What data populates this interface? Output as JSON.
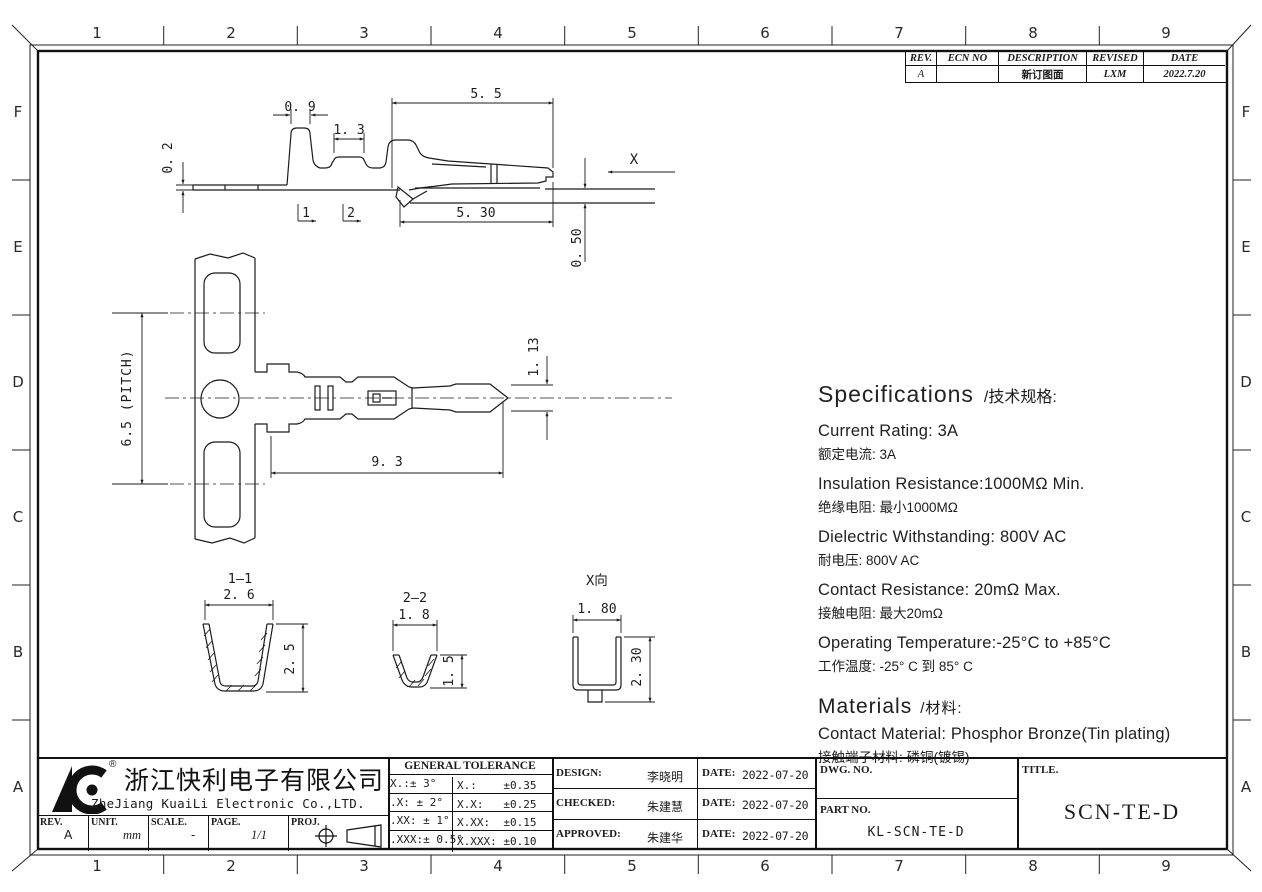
{
  "page": {
    "bg": "#ffffff",
    "line_color": "#1c1c1c"
  },
  "grid": {
    "cols": [
      "1",
      "2",
      "3",
      "4",
      "5",
      "6",
      "7",
      "8",
      "9"
    ],
    "rows": [
      "F",
      "E",
      "D",
      "C",
      "B",
      "A"
    ]
  },
  "rev_table": {
    "col_rev": "REV.",
    "col_ecn": "ECN NO",
    "col_desc": "DESCRIPTION",
    "col_revised": "REVISED",
    "col_date": "DATE",
    "rev": "A",
    "ecn": "",
    "desc": "新订图面",
    "revised": "LXM",
    "date": "2022.7.20"
  },
  "dims": {
    "side": {
      "w1": "0. 9",
      "w2": "1. 3",
      "w3": "5. 5",
      "t": "0. 2",
      "w4": "5. 30",
      "h": "0. 50",
      "sec1": "1",
      "sec2": "2",
      "xdir": "X"
    },
    "plan": {
      "pitch": "6.5 (PITCH)",
      "len": "9. 3",
      "tip": "1. 13"
    },
    "sec11": {
      "label": "1—1",
      "w": "2. 6",
      "h": "2. 5"
    },
    "sec22": {
      "label": "2—2",
      "w": "1. 8",
      "h": "1. 5"
    },
    "secx": {
      "label": "X向",
      "w": "1. 80",
      "h": "2. 30"
    }
  },
  "specs": {
    "title_en": "Specifications",
    "title_zh": "/技术规格:",
    "items": [
      {
        "en": "Current Rating:  3A",
        "zh": "额定电流: 3A"
      },
      {
        "en": "Insulation Resistance:1000MΩ  Min.",
        "zh": "绝缘电阻: 最小1000MΩ"
      },
      {
        "en": "Dielectric Withstanding:  800V AC",
        "zh": "耐电压: 800V AC"
      },
      {
        "en": "Contact Resistance:  20mΩ  Max.",
        "zh": "接触电阻: 最大20mΩ"
      },
      {
        "en": "Operating Temperature:-25°C to +85°C",
        "zh": "工作温度: -25° C 到 85° C"
      }
    ],
    "materials_title_en": "Materials",
    "materials_title_zh": "/材料:",
    "material_en": "Contact Material: Phosphor Bronze(Tin plating)",
    "material_zh": "接触端子材料: 磷铜(镀锡)"
  },
  "title_block": {
    "company_zh": "浙江快利电子有限公司",
    "company_en": "ZheJiang KuaiLi Electronic Co.,LTD.",
    "reg_mark": "®",
    "tol_header": "GENERAL TOLERANCE",
    "tol_rows": [
      {
        "a": "X.:± 3°",
        "b": "X.:    ±0.35"
      },
      {
        "a": ".X: ± 2°",
        "b": "X.X:   ±0.25"
      },
      {
        "a": ".XX: ± 1°",
        "b": "X.XX:  ±0.15"
      },
      {
        "a": ".XXX:± 0.5°",
        "b": "X.XXX: ±0.10"
      }
    ],
    "design_label": "DESIGN:",
    "design_name": "李晓明",
    "design_date_label": "DATE:",
    "design_date": "2022-07-20",
    "checked_label": "CHECKED:",
    "checked_name": "朱建慧",
    "checked_date_label": "DATE:",
    "checked_date": "2022-07-20",
    "approved_label": "APPROVED:",
    "approved_name": "朱建华",
    "approved_date_label": "DATE:",
    "approved_date": "2022-07-20",
    "dwg_no_label": "DWG. NO.",
    "part_no_label": "PART NO.",
    "part_no": "KL-SCN-TE-D",
    "title_label": "TITLE.",
    "title": "SCN-TE-D",
    "rev_label": "REV.",
    "rev": "A",
    "unit_label": "UNIT.",
    "unit": "mm",
    "scale_label": "SCALE.",
    "scale": "-",
    "page_label": "PAGE.",
    "page": "1/1",
    "proj_label": "PROJ."
  }
}
